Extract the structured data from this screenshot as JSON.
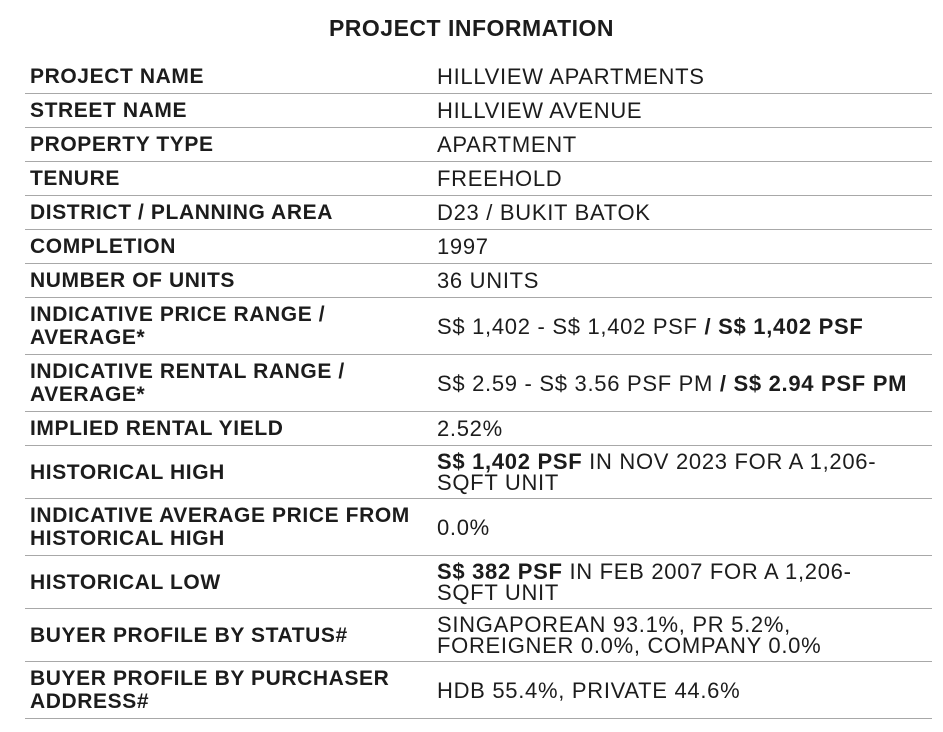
{
  "title": "PROJECT INFORMATION",
  "colors": {
    "background": "#ffffff",
    "text": "#1c1c1c",
    "divider": "#a8a8a8"
  },
  "table": {
    "rows": [
      {
        "label": "PROJECT NAME",
        "value": [
          {
            "text": "HILLVIEW APARTMENTS",
            "bold": false
          }
        ]
      },
      {
        "label": "STREET NAME",
        "value": [
          {
            "text": "HILLVIEW AVENUE",
            "bold": false
          }
        ]
      },
      {
        "label": "PROPERTY TYPE",
        "value": [
          {
            "text": "APARTMENT",
            "bold": false
          }
        ]
      },
      {
        "label": "TENURE",
        "value": [
          {
            "text": "FREEHOLD",
            "bold": false
          }
        ]
      },
      {
        "label": "DISTRICT / PLANNING AREA",
        "value": [
          {
            "text": "D23 / BUKIT BATOK",
            "bold": false
          }
        ]
      },
      {
        "label": "COMPLETION",
        "value": [
          {
            "text": "1997",
            "bold": false
          }
        ]
      },
      {
        "label": "NUMBER OF UNITS",
        "value": [
          {
            "text": "36 UNITS",
            "bold": false
          }
        ]
      },
      {
        "label": "INDICATIVE PRICE RANGE / AVERAGE*",
        "value": [
          {
            "text": "S$ 1,402 - S$ 1,402 PSF ",
            "bold": false
          },
          {
            "text": "/ S$ 1,402 PSF",
            "bold": true
          }
        ]
      },
      {
        "label": "INDICATIVE RENTAL RANGE / AVERAGE*",
        "value": [
          {
            "text": "S$ 2.59 - S$ 3.56 PSF PM ",
            "bold": false
          },
          {
            "text": "/ S$ 2.94 PSF PM",
            "bold": true
          }
        ]
      },
      {
        "label": "IMPLIED RENTAL YIELD",
        "value": [
          {
            "text": "2.52%",
            "bold": false
          }
        ]
      },
      {
        "label": "HISTORICAL HIGH",
        "value": [
          {
            "text": "S$ 1,402 PSF",
            "bold": true
          },
          {
            "text": " IN NOV 2023 FOR A 1,206-\nSQFT UNIT",
            "bold": false
          }
        ]
      },
      {
        "label": "INDICATIVE AVERAGE PRICE FROM HISTORICAL HIGH",
        "value": [
          {
            "text": "0.0%",
            "bold": false
          }
        ]
      },
      {
        "label": "HISTORICAL LOW",
        "value": [
          {
            "text": "S$ 382 PSF",
            "bold": true
          },
          {
            "text": " IN FEB 2007 FOR A 1,206-\nSQFT UNIT",
            "bold": false
          }
        ]
      },
      {
        "label": "BUYER PROFILE BY STATUS#",
        "value": [
          {
            "text": "SINGAPOREAN 93.1%, PR 5.2%,\nFOREIGNER 0.0%, COMPANY 0.0%",
            "bold": false
          }
        ]
      },
      {
        "label": "BUYER PROFILE BY PURCHASER ADDRESS#",
        "value": [
          {
            "text": "HDB 55.4%, PRIVATE 44.6%",
            "bold": false
          }
        ]
      }
    ]
  }
}
